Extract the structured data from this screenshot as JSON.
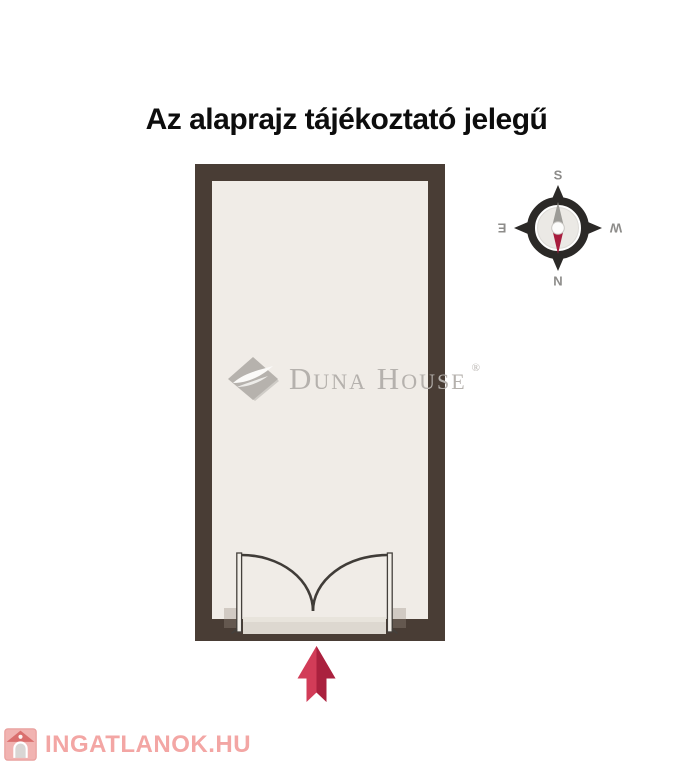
{
  "title": "Az alaprajz tájékoztató jelegű",
  "floorplan": {
    "wall_color": "#493d35",
    "floor_color": "#f0ece7",
    "door": {
      "arc_color": "#403c38",
      "leaf_fill": "#f2efe9",
      "leaf_stroke": "#44403c",
      "threshold_color": "#ddd8d0",
      "threshold_highlight": "#e8e4dc"
    }
  },
  "entrance_arrow": {
    "direction": "up",
    "color": "#d23c58",
    "shade_color": "#a31c39"
  },
  "compass": {
    "top_label": "S",
    "bottom_label": "N",
    "left_label": "E",
    "right_label": "W",
    "label_color": "#8d8c8a",
    "ring_color": "#2b2927",
    "needle_up_color": "#9c9b97",
    "needle_down_color": "#a81d3e"
  },
  "watermark": {
    "brand": "Duna House",
    "registered": "®"
  },
  "footer_logo": {
    "text": "INGATLANOK.HU",
    "color": "#f3a6a4"
  }
}
